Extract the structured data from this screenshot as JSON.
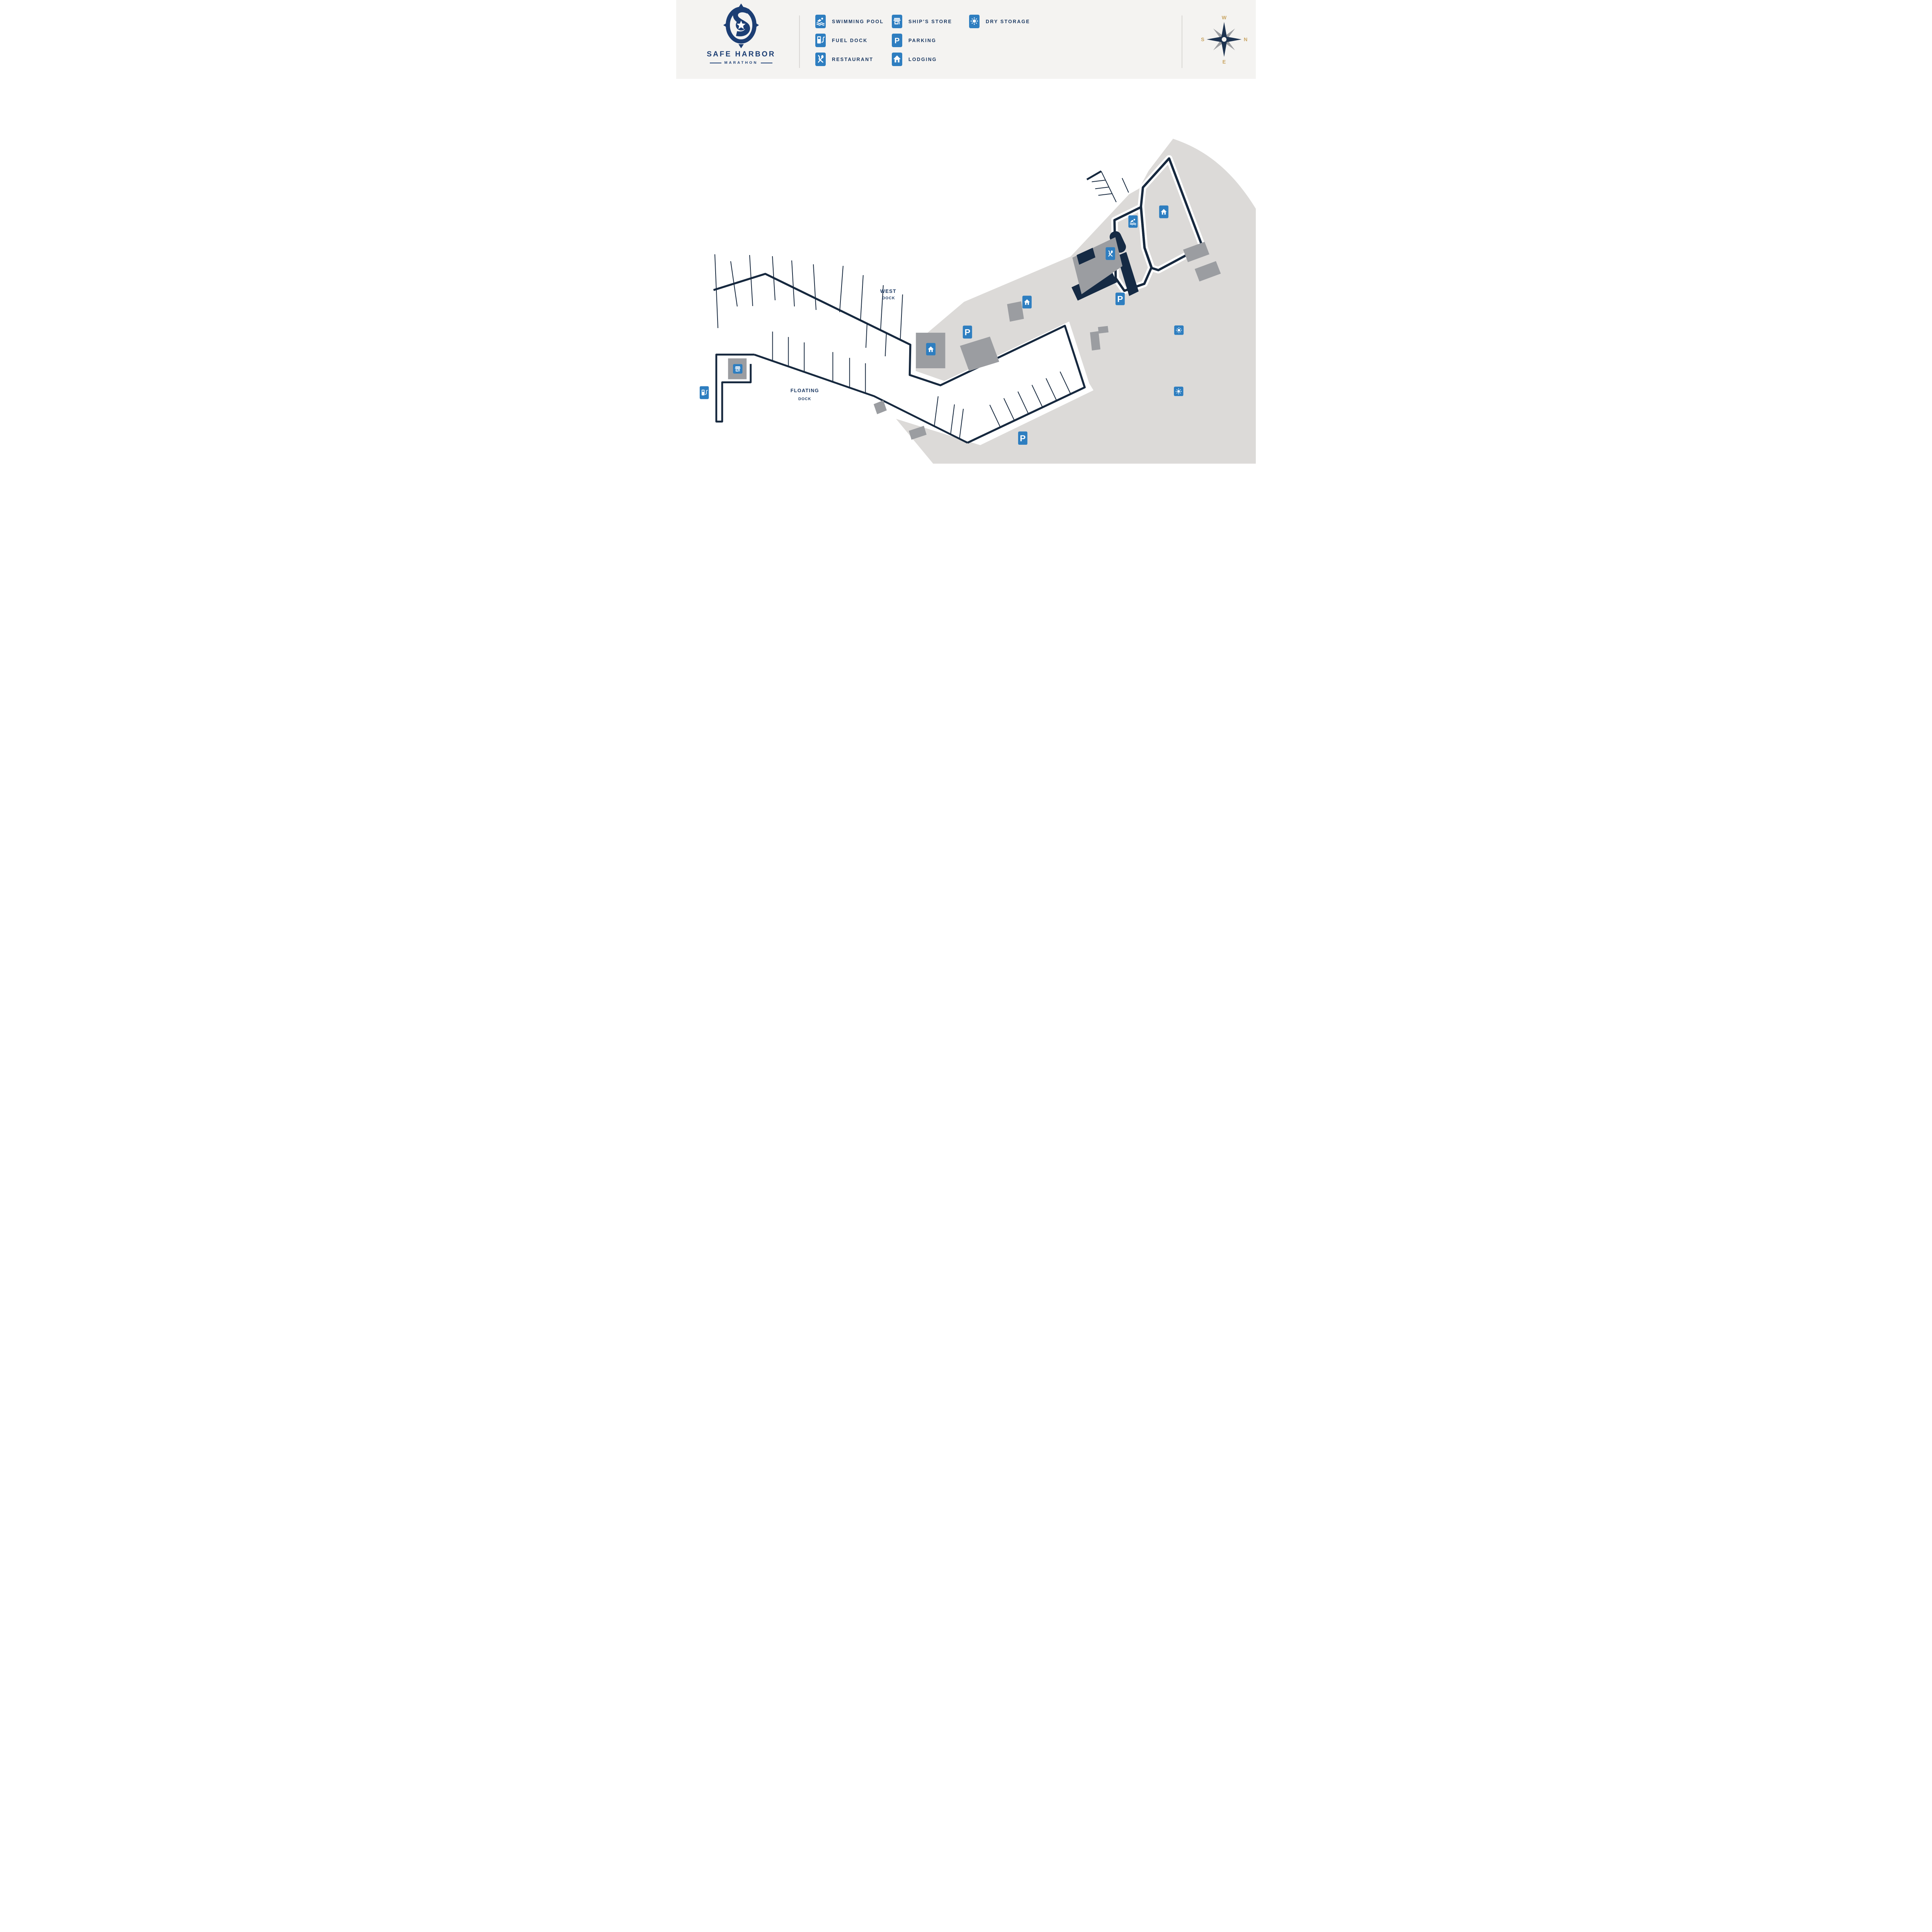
{
  "logo": {
    "title": "SAFE HARBOR",
    "subtitle": "MARATHON"
  },
  "legend": {
    "items": [
      {
        "icon": "swimming-pool-icon",
        "label": "SWIMMING POOL"
      },
      {
        "icon": "fuel-dock-icon",
        "label": "FUEL DOCK"
      },
      {
        "icon": "restaurant-icon",
        "label": "RESTAURANT"
      },
      {
        "icon": "ships-store-icon",
        "label": "SHIP'S STORE"
      },
      {
        "icon": "parking-icon",
        "label": "PARKING"
      },
      {
        "icon": "lodging-icon",
        "label": "LODGING"
      },
      {
        "icon": "dry-storage-icon",
        "label": "DRY STORAGE"
      }
    ]
  },
  "compass": {
    "top": "W",
    "right": "N",
    "bottom": "E",
    "left": "S"
  },
  "map": {
    "west_dock": {
      "line1": "WEST",
      "line2": "DOCK"
    },
    "floating_dock": {
      "line1": "FLOATING",
      "line2": "DOCK"
    },
    "markers": [
      "lodging-northeast",
      "swimming-pool",
      "restaurant",
      "parking-west",
      "lodging-center",
      "parking-center",
      "lodging-peninsula",
      "ships-store",
      "fuel-dock",
      "parking-south",
      "dry-storage-north",
      "dry-storage-south"
    ]
  },
  "icons": {
    "parking_letter": "P"
  },
  "colors": {
    "accent_blue": "#2e7ec0",
    "navy_text": "#1d3a63",
    "logo_navy": "#1c3e74",
    "map_line": "#16283e",
    "gold": "#c8a360",
    "land": "#dcdad8",
    "building": "#9b9da1",
    "header_bg": "#f4f3f1"
  }
}
